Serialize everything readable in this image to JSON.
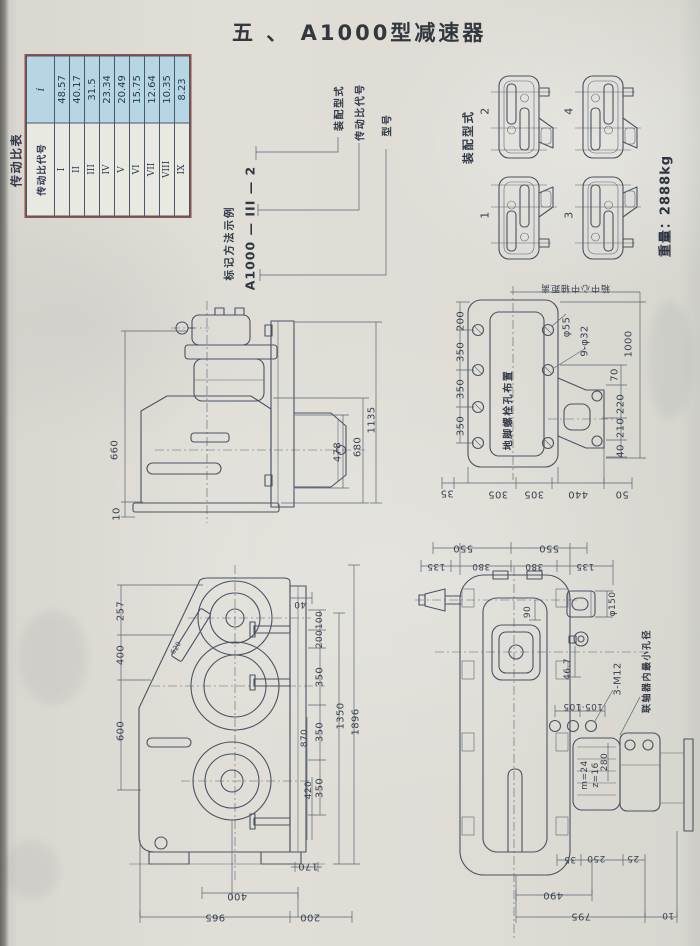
{
  "page": {
    "title": "五 、 A1000型减速器"
  },
  "ratio_table": {
    "title": "传动比表",
    "header": {
      "code": "传动比代号",
      "ratio": "i"
    },
    "rows": [
      {
        "code": "I",
        "value": "48.57"
      },
      {
        "code": "II",
        "value": "40.17"
      },
      {
        "code": "III",
        "value": "31.5"
      },
      {
        "code": "IV",
        "value": "23.34"
      },
      {
        "code": "V",
        "value": "20.49"
      },
      {
        "code": "VI",
        "value": "15.75"
      },
      {
        "code": "VII",
        "value": "12.64"
      },
      {
        "code": "VIII",
        "value": "10.35"
      },
      {
        "code": "IX",
        "value": "8.23"
      }
    ]
  },
  "marking": {
    "caption": "标记方法示例",
    "code": "A1000 — III — 2",
    "labels": {
      "assembly": "装配型式",
      "ratio": "传动比代号",
      "model": "型号"
    }
  },
  "assembly": {
    "caption": "装配型式",
    "type1": "1",
    "type2": "2",
    "type3": "3",
    "type4": "4",
    "weight": "重量：2888kg"
  },
  "front_view": {
    "dims": {
      "d660": "660",
      "d10": "10",
      "d478": "478",
      "d680": "680",
      "d1135": "1135"
    }
  },
  "plan_view": {
    "top_label": "箱中心中轴距离",
    "area_label": "地脚螺栓孔布置",
    "dims": {
      "d200": "200",
      "d350a": "350",
      "d350b": "350",
      "d350c": "350",
      "phi55": "φ55",
      "holes": "9-φ32",
      "d1000": "1000",
      "d70": "70",
      "d220": "220",
      "d210": "210",
      "d40": "40",
      "d35": "35",
      "d305a": "305",
      "d305b": "305",
      "d440": "440",
      "d50": "50"
    }
  },
  "side_view": {
    "dims": {
      "d257": "257",
      "d400": "400",
      "d600": "600",
      "d40": "40",
      "d100": "100",
      "d200": "200",
      "d350a": "350",
      "d350b": "350",
      "d350c": "350",
      "d870": "870",
      "d420": "420",
      "d1350": "1350",
      "d1896": "1896",
      "d170": "170",
      "d400b": "400",
      "d965": "965",
      "d200b": "200",
      "d620": "620"
    }
  },
  "top_view": {
    "coupling_label": "联轴器内最小孔径",
    "bolt_label": "3-M12",
    "gear_label_m": "m=24",
    "gear_label_z": "z=16",
    "dims": {
      "d550a": "550",
      "d550b": "550",
      "d135a": "135",
      "d380a": "380",
      "d380b": "380",
      "d135b": "135",
      "d90": "90",
      "phi150": "φ150",
      "d46_7": "46.7",
      "d105": "105·105",
      "d280": "280",
      "d35": "35",
      "d250": "250",
      "d25": "25",
      "d490": "490",
      "d795": "795",
      "d10": "10"
    }
  }
}
